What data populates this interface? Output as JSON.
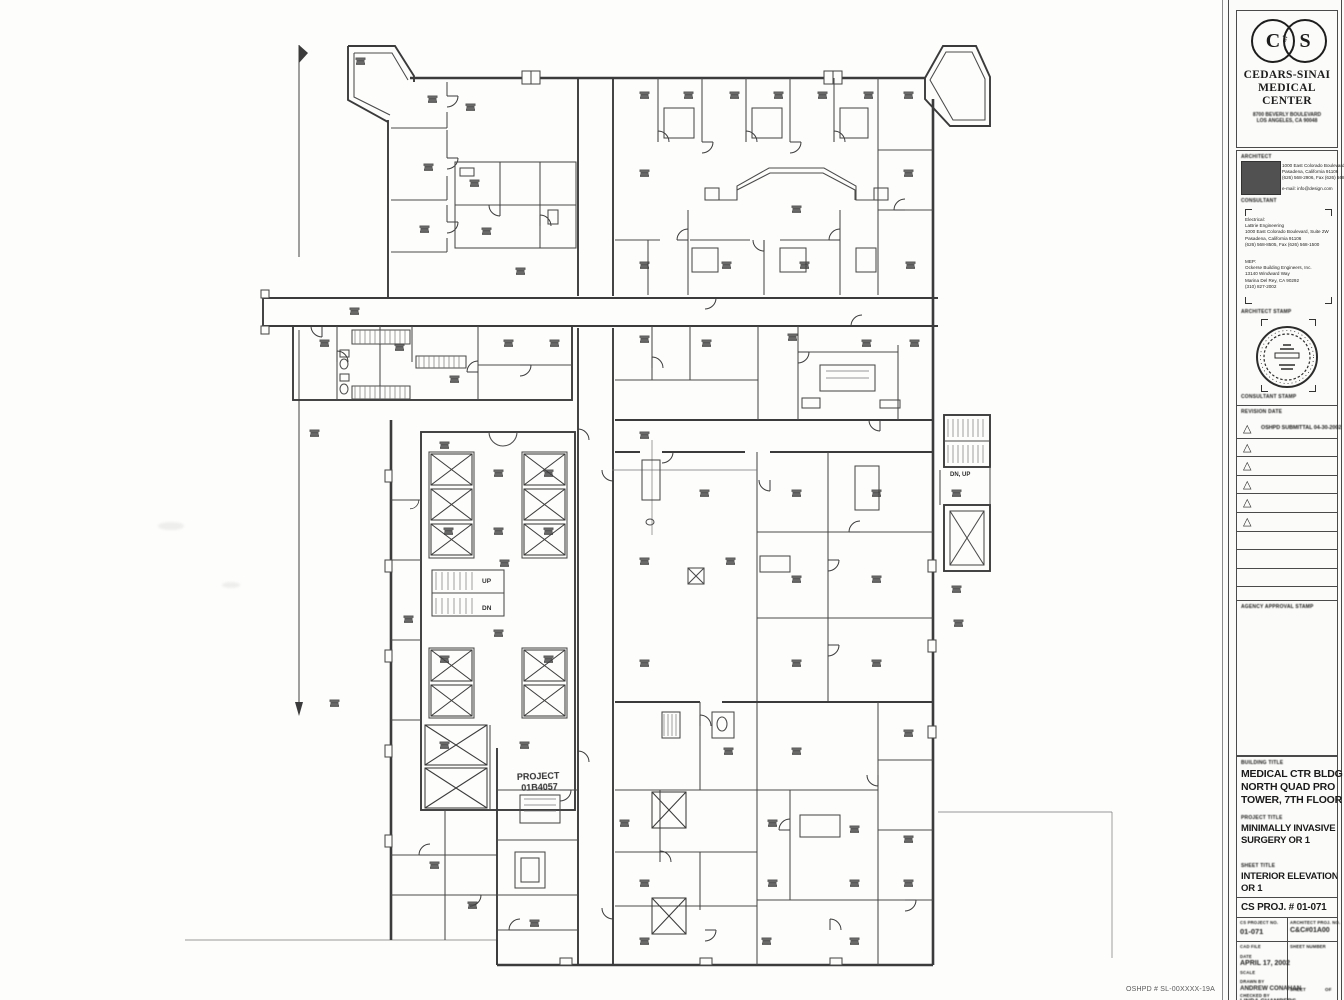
{
  "plan": {
    "stair_up": "UP",
    "stair_dn": "DN",
    "stair2": "DN, UP",
    "project_stamp_line1": "PROJECT",
    "project_stamp_line2": "01B4057",
    "oshpd_note": "OSHPD # SL-00XXXX-19A"
  },
  "titleblock": {
    "logo": {
      "letter_c": "C",
      "letter_s": "S",
      "caduceus": "⚕",
      "name_line1": "CEDARS-SINAI",
      "name_line2": "MEDICAL CENTER",
      "address_line1": "8700 BEVERLY BOULEVARD",
      "address_line2": "LOS ANGELES, CA 90048"
    },
    "architect": {
      "label": "ARCHITECT",
      "line1": "1000 East Colorado Boulevard, Suite 2W",
      "line2": "Pasadena, California 91106",
      "line3": "(626) 568-2906,  Fax (626) 568-8101",
      "line4": "e-mail: info@design.com"
    },
    "consultant": {
      "label": "CONSULTANT",
      "g1_title": "Electrical:",
      "g1_line1": "LaBrie Engineering",
      "g1_line2": "1000 East Colorado Boulevard, Suite 2W",
      "g1_line3": "Pasadena, California 91106",
      "g1_line4": "(626) 568-8505,  Fax (626) 568-1500",
      "g2_title": "MEP:",
      "g2_line1": "Ockerse Building Engineers, Inc.",
      "g2_line2": "13140 Windward Way",
      "g2_line3": "Marina Del Rey, CA 90292",
      "g2_line4": "(310) 827-2002"
    },
    "architect_stamp_label": "ARCHITECT STAMP",
    "consultant_stamp_label": "CONSULTANT STAMP",
    "revision": {
      "label": "REVISION DATE",
      "first_entry": "OSHPD SUBMITTAL 04-30-2002"
    },
    "agency_label": "AGENCY APPROVAL STAMP",
    "building": {
      "label": "BUILDING TITLE",
      "line1": "MEDICAL CTR BLDG",
      "line2": "NORTH QUAD PRO",
      "line3": "TOWER, 7TH FLOOR"
    },
    "project": {
      "label": "PROJECT TITLE",
      "line1": "MINIMALLY INVASIVE",
      "line2": "SURGERY OR 1"
    },
    "sheet": {
      "label": "SHEET TITLE",
      "line1": "INTERIOR ELEVATIONS",
      "line2": "OR 1"
    },
    "cs_proj": "CS PROJ. # 01-071",
    "grid": {
      "left_no_label": "CS PROJECT NO.",
      "left_no": "01-071",
      "right_no_label": "ARCHITECT PROJ. NO.",
      "right_no": "C&C#01A00",
      "cad_label": "CAD FILE",
      "sheet_number_label": "SHEET NUMBER",
      "date_label": "DATE",
      "date": "APRIL 17, 2002",
      "scale_label": "SCALE",
      "drawn_label": "DRAWN BY",
      "drawn": "ANDREW CONAHAN",
      "checked_label": "CHECKED BY",
      "checked": "LINDA CHAMBERS",
      "sheet_label": "SHEET",
      "of_label": "OF"
    }
  }
}
